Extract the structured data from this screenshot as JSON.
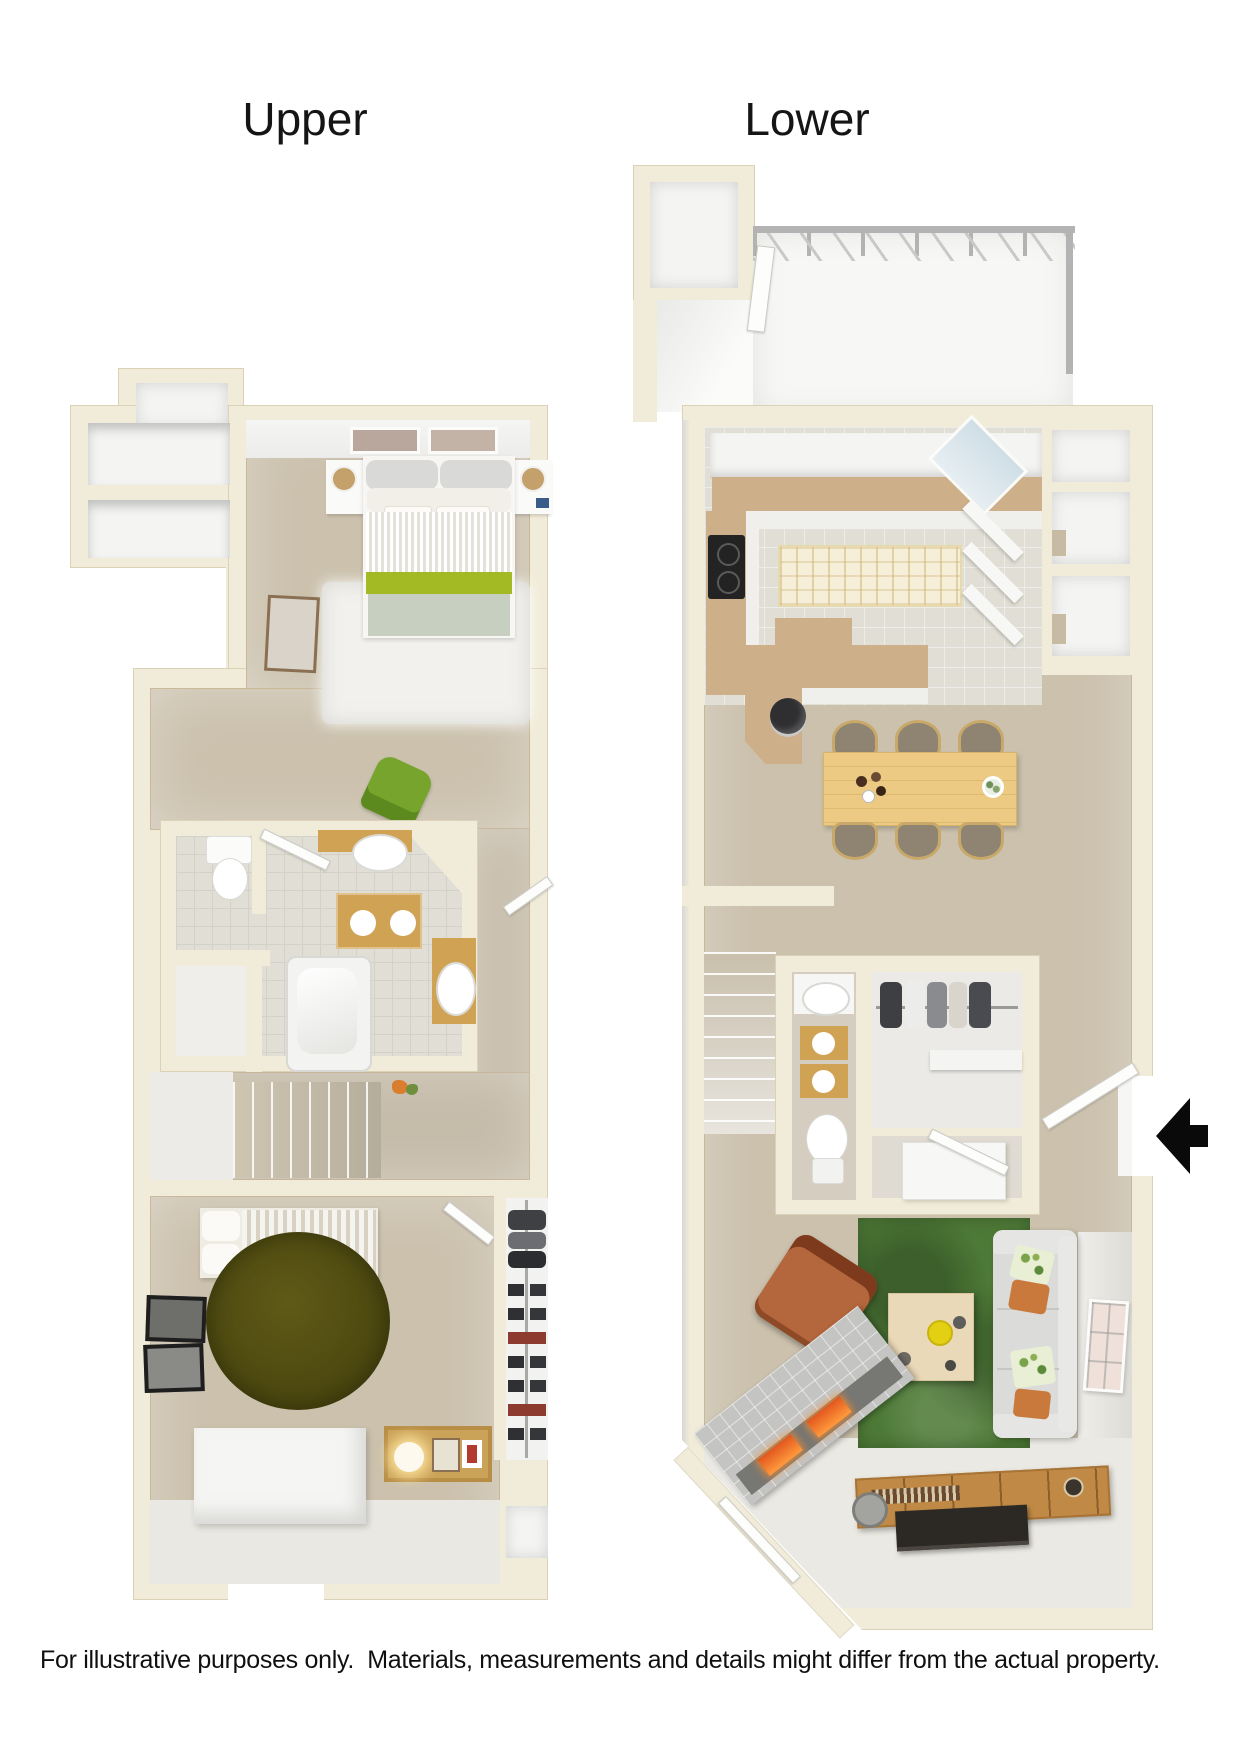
{
  "titles": {
    "upper": "Upper",
    "lower": "Lower"
  },
  "disclaimer": {
    "text": "For illustrative purposes only.  Materials, measurements and details might differ from the actual property."
  },
  "entrance": {
    "icon": "arrow-left-icon",
    "direction": "left",
    "color": "#0a0a0a"
  },
  "palette": {
    "wall": "#f1ecd9",
    "carpet": "#cbc1ad",
    "carpet2": "#c6bcaa",
    "tile": "#e1dfd5",
    "gold": "#d0a254",
    "wood": "#ecca83",
    "wood-dark": "#c08a46",
    "green-rug": "#4e7a37",
    "olive-rug": "#55500f",
    "bed-green": "#a4ba25",
    "bed-sage": "#c7cfc0",
    "sofa": "#dbdbd9",
    "armchair": "#a9572e",
    "tv": "#2c2925",
    "fire": "#e2571e",
    "railing": "#b3b3b3"
  }
}
